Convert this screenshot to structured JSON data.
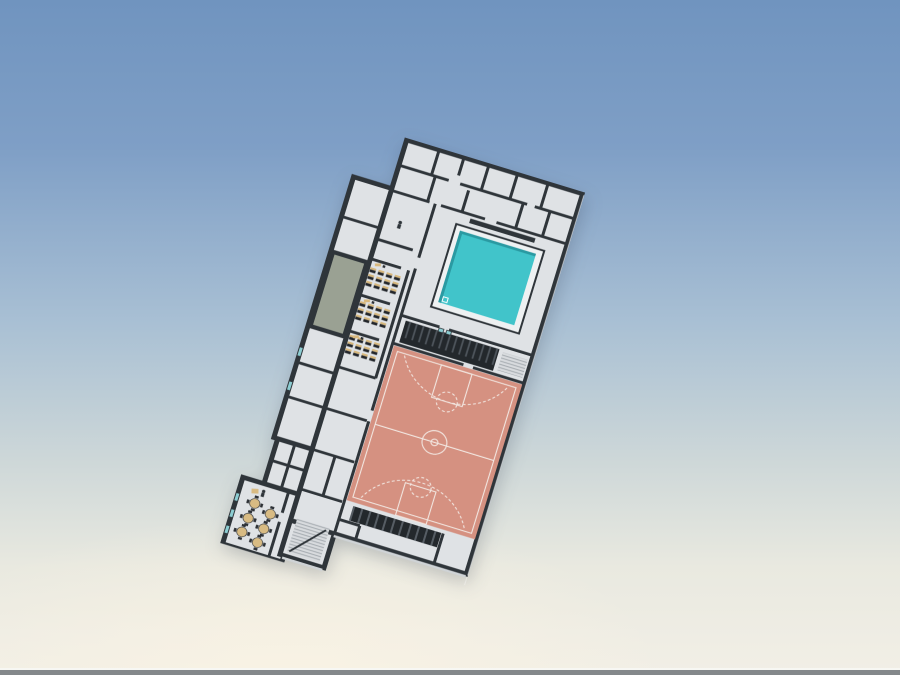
{
  "scene": {
    "type": "3d-architectural-render",
    "subject": "Tilted isometric floor plan of a school sports facility floating on a sky gradient",
    "building_rotation_deg": 17
  },
  "colors": {
    "sky_top": "#7094bf",
    "sky_mid": "#a9c0d4",
    "sky_low": "#e9e9e0",
    "sky_bottom": "#f2efe6",
    "ground_strip": "#84888b",
    "ground_strip_highlight": "#f7f7f3",
    "wall": "#2f353a",
    "wall_light": "#cfd3d6",
    "floor": "#dfe2e5",
    "pool_rim": "#eef1f2",
    "pool_water": "#41c4ca",
    "pool_water_shade": "#2a9aa2",
    "court": "#d59181",
    "court_line": "#f2e6e0",
    "terrace": "#9aa193",
    "desk_top": "#d8b87c",
    "desk_body": "#23262b",
    "table": "#d8bb83",
    "chair": "#2c3035",
    "bleacher": "#23282c",
    "bleacher_stripe": "#4d545b",
    "stair": "#d8dbde",
    "stair_stripe": "#a6acb1",
    "window_glass": "#8ccdd2",
    "glass_panel": "rgba(255,255,255,0.35)"
  },
  "building": {
    "features": [
      "changing-rooms",
      "swimming-pool",
      "pool-bleachers",
      "basketball-court",
      "classrooms",
      "green-terrace",
      "cafeteria",
      "staircases",
      "corridors",
      "glass-panel"
    ],
    "classrooms": {
      "count": 3,
      "desks_per_room": 12,
      "desk_rows": 3,
      "desk_columns": 4
    },
    "cafeteria": {
      "round_tables": 6,
      "chairs_per_table": 4
    },
    "pool": {
      "shape": "rectangular",
      "rim": "white deck border"
    },
    "basketball_court": {
      "markings": [
        "boundary",
        "half-court-line",
        "center-circle",
        "free-throw-keys",
        "free-throw-circles",
        "three-point-arcs"
      ]
    },
    "staircases": 2
  }
}
